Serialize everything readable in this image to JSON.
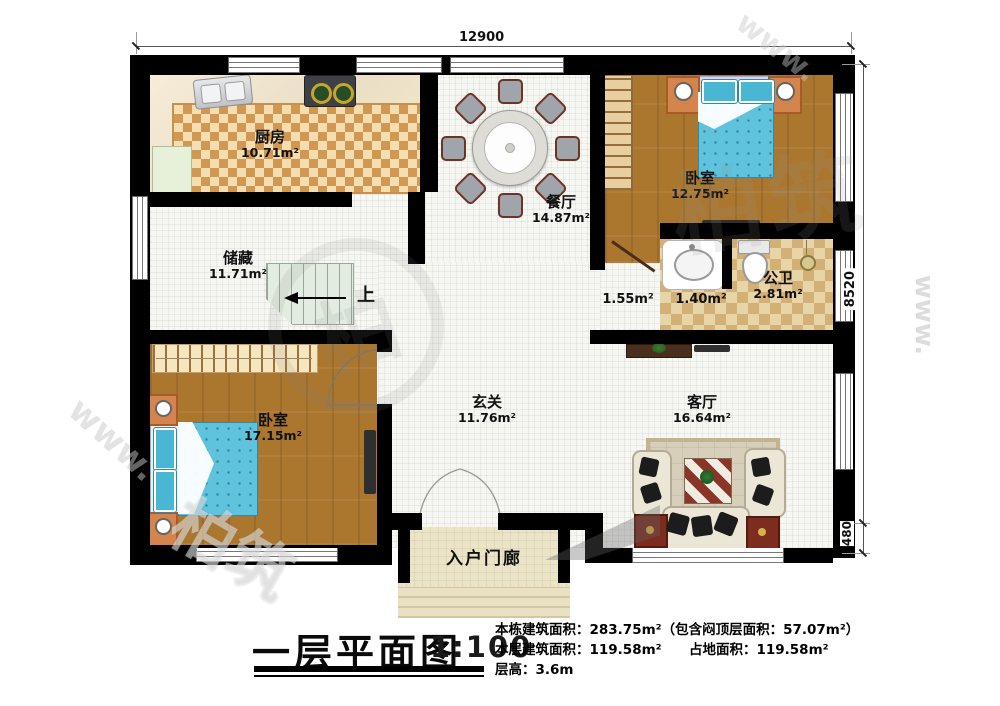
{
  "dimensions": {
    "top_width": "12900",
    "right_main": "8520",
    "right_lower": "480"
  },
  "rooms": {
    "kitchen": {
      "name": "厨房",
      "area": "10.71m²"
    },
    "dining": {
      "name": "餐厅",
      "area": "14.87m²"
    },
    "bedroom1": {
      "name": "卧室",
      "area": "12.75m²"
    },
    "storage": {
      "name": "储藏",
      "area": "11.71m²"
    },
    "corridor": {
      "area": "1.55m²"
    },
    "washroom": {
      "area": "1.40m²"
    },
    "bathroom": {
      "name": "公卫",
      "area": "2.81m²"
    },
    "bedroom2": {
      "name": "卧室",
      "area": "17.15m²"
    },
    "hall": {
      "name": "玄关",
      "area": "11.76m²"
    },
    "living": {
      "name": "客厅",
      "area": "16.64m²"
    },
    "porch": {
      "name": "入户门廊"
    }
  },
  "stairs": {
    "up_label": "上"
  },
  "watermark": {
    "brand": "柏筑",
    "logo_char": "柏",
    "url_fragment": "www."
  },
  "title_block": {
    "title": "一层平面图",
    "scale": "1:100",
    "info_line1": "本栋建筑面积：283.75m²（包含闷顶层面积：57.07m²）",
    "info_line2a": "本层建筑面积：119.58m²",
    "info_line2b": "占地面积：119.58m²",
    "info_line3": "层高：3.6m"
  },
  "colors": {
    "wall": "#000000",
    "wood": "#ab772f",
    "bed": "#5fc3de",
    "accent_red": "#7c2d1f"
  }
}
